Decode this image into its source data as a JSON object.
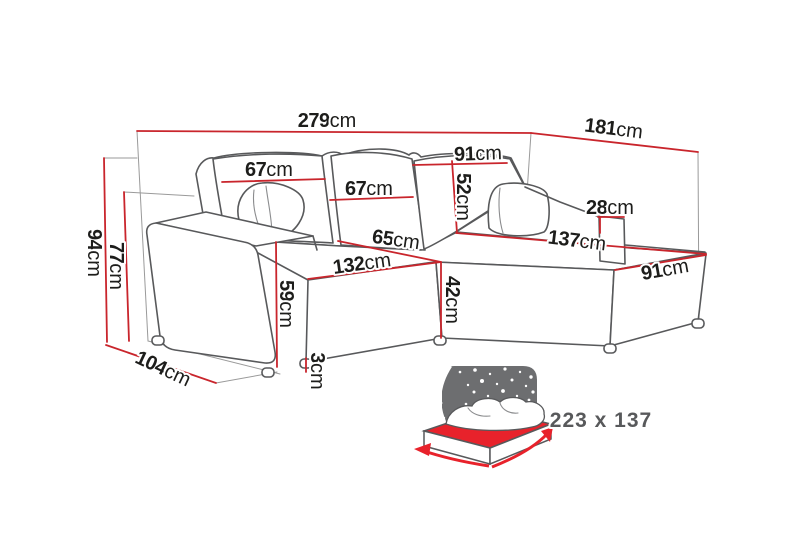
{
  "page": {
    "background": "#ffffff"
  },
  "diagram": {
    "title": "corner-sofa-dimensions",
    "unit_label": "cm",
    "dimensions": {
      "total_width": {
        "value": "279",
        "unit": "cm"
      },
      "total_depth_right": {
        "value": "181",
        "unit": "cm"
      },
      "total_height": {
        "value": "94",
        "unit": "cm"
      },
      "backrest_height": {
        "value": "77",
        "unit": "cm"
      },
      "side_depth": {
        "value": "104",
        "unit": "cm"
      },
      "back_cushion_left_width": {
        "value": "67",
        "unit": "cm"
      },
      "back_cushion_middle_width": {
        "value": "67",
        "unit": "cm"
      },
      "corner_backrest_width": {
        "value": "91",
        "unit": "cm"
      },
      "backrest_above_seat_height": {
        "value": "52",
        "unit": "cm"
      },
      "right_armrest_height": {
        "value": "28",
        "unit": "cm"
      },
      "chaise_length": {
        "value": "137",
        "unit": "cm"
      },
      "chaise_width": {
        "value": "91",
        "unit": "cm"
      },
      "seat_depth": {
        "value": "65",
        "unit": "cm"
      },
      "seat_width": {
        "value": "132",
        "unit": "cm"
      },
      "seat_height": {
        "value": "42",
        "unit": "cm"
      },
      "left_armrest_height": {
        "value": "59",
        "unit": "cm"
      },
      "leg_height": {
        "value": "3",
        "unit": "cm"
      }
    },
    "sleeping_area": {
      "label": "223 x 137"
    },
    "colors": {
      "dimension_line_red": "#c9252c",
      "outline_gray": "#58595b",
      "helper_gray": "#9a9a9a",
      "night_panel_gray": "#6d6e70",
      "bed_sheet_red": "#e8222b",
      "label_black": "#1d1d1b",
      "sleeping_text_gray": "#58595b"
    }
  }
}
